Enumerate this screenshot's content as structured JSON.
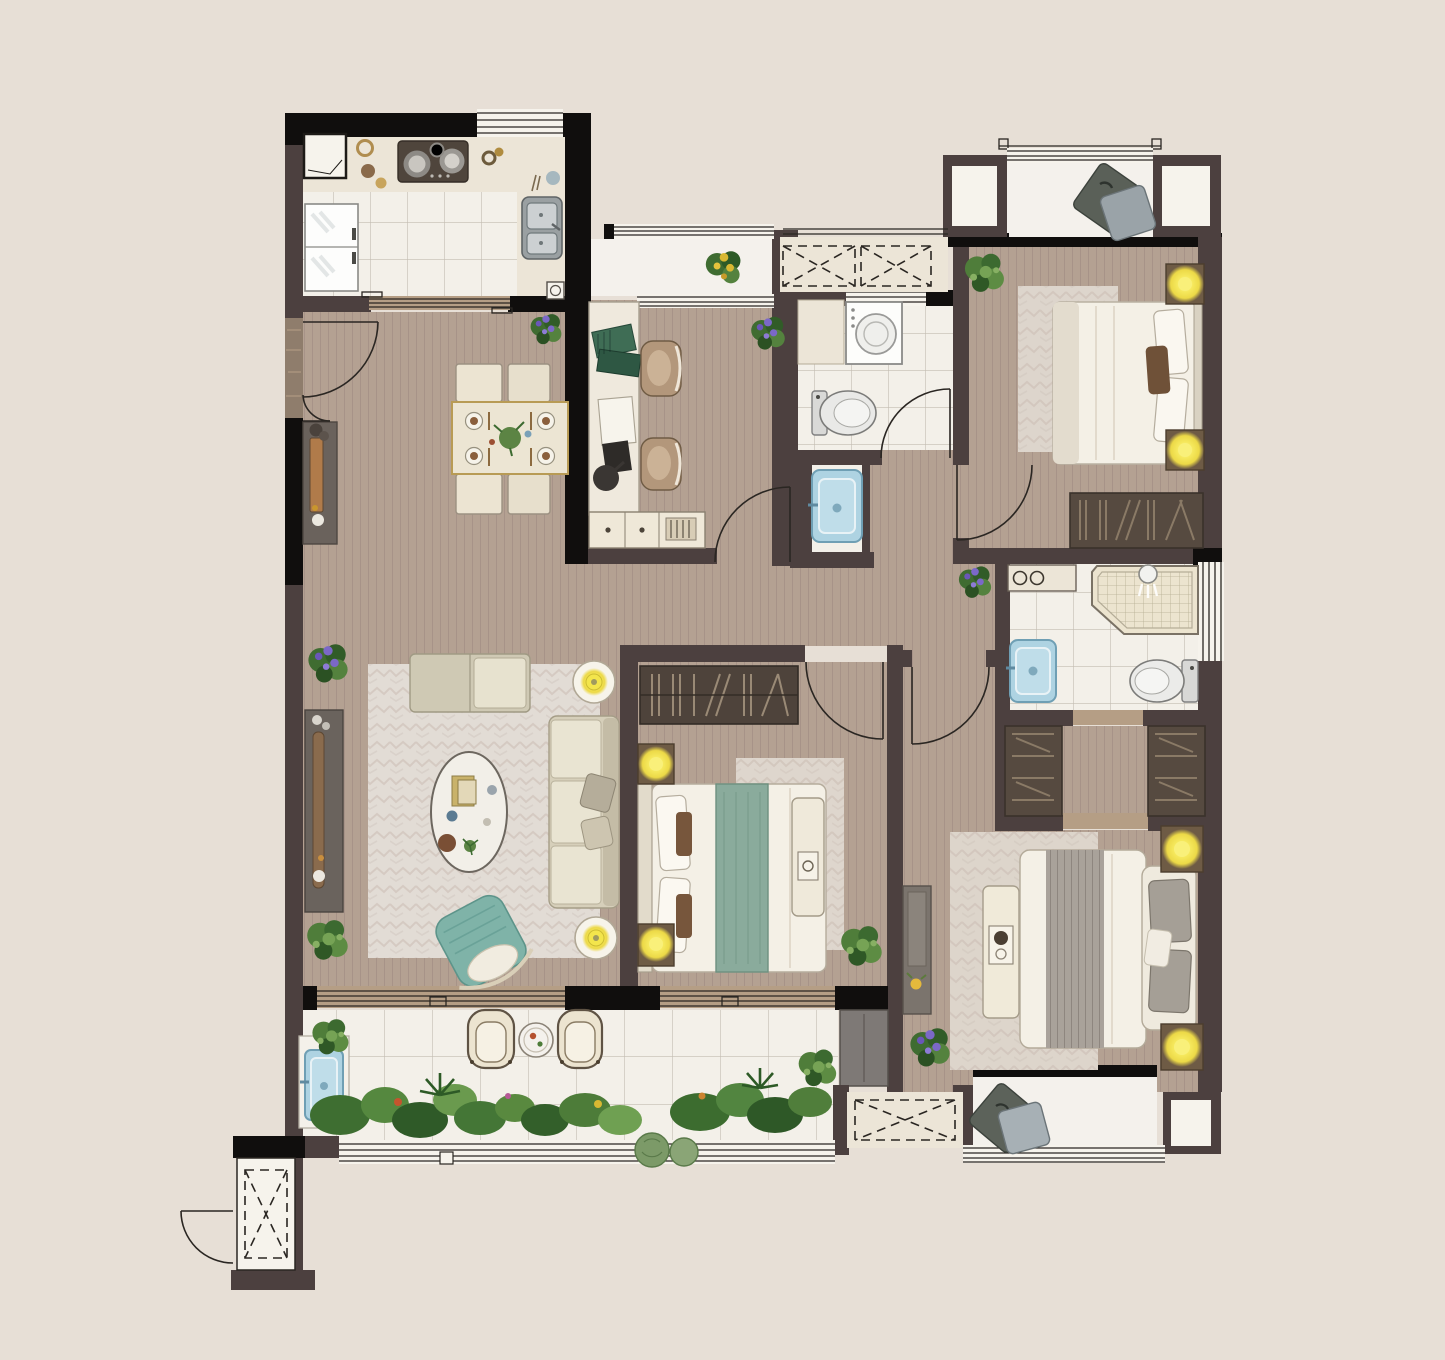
{
  "app": {
    "type": "residential-floor-plan",
    "view": "top-down-color-render",
    "visible_text": "none"
  },
  "palette": {
    "bg": "#e7dfd6",
    "wallDark": "#4c403f",
    "wallBlack": "#100e0d",
    "entryTexture": "#8f7d6c",
    "wood": "#b4a192",
    "woodLine": "#a38f84",
    "woodSill": "#b59e85",
    "tileWhite": "#f3f0e9",
    "tileLine": "#c3bdb2",
    "cream": "#ece5d7",
    "winWhite": "#f6f3ec",
    "lineDark": "#2a2622",
    "marble": "#f4f1ec",
    "rug": "#e2dcd5",
    "rugLine": "#c9bcb3",
    "sofa": "#d6cfba",
    "teal": "#7fb3a8",
    "bedRunnerGreen": "#8aab9c",
    "lampYellow": "#f3e54c",
    "nightstand": "#6e5b45",
    "wardrobe": "#564a40",
    "shelfDark": "#4e433b",
    "plantGreen": "#4d7c39",
    "plantDark": "#2f5a28",
    "flowerPurple": "#7b68c8",
    "flowerYellow": "#d8b832",
    "sinkBlue": "#aed3e2",
    "sinkBlueEdge": "#6f9fb4",
    "greyDoor": "#7e7976",
    "console": "#6a635d",
    "bedWhite": "#f4f0e6",
    "pillowGrey": "#a59f96",
    "shower": "#ece4cf",
    "stove": "#4f453c"
  },
  "rooms": [
    {
      "name": "kitchen",
      "floor": "white-tile",
      "furniture": [
        "cooktop",
        "double-sink",
        "fridge",
        "counter",
        "floor-drain",
        "corner-cabinet"
      ]
    },
    {
      "name": "dining-area",
      "floor": "wood",
      "furniture": [
        "dining-table",
        "dining-chairs-x4",
        "sideboard",
        "plants"
      ]
    },
    {
      "name": "study",
      "floor": "wood",
      "furniture": [
        "desk",
        "task-chairs-x2",
        "low-cabinet",
        "desk-lamp",
        "plant"
      ]
    },
    {
      "name": "study-balcony",
      "floor": "marble",
      "furniture": [
        "flower-pot"
      ]
    },
    {
      "name": "laundry-bathroom",
      "floor": "white-tile",
      "furniture": [
        "washing-machine",
        "toilet",
        "wash-basin"
      ]
    },
    {
      "name": "bedroom-north",
      "floor": "wood",
      "furniture": [
        "double-bed",
        "nightstands-x2",
        "lamps-x2",
        "rug",
        "wardrobe",
        "bay-window-seat",
        "plant"
      ]
    },
    {
      "name": "ensuite-bathroom",
      "floor": "white-tile",
      "furniture": [
        "walk-in-shower",
        "toilet",
        "wash-basin",
        "counter"
      ]
    },
    {
      "name": "walk-in-closet",
      "floor": "wood",
      "furniture": [
        "wardrobe-left",
        "wardrobe-right"
      ]
    },
    {
      "name": "bedroom-middle",
      "floor": "wood",
      "furniture": [
        "double-bed",
        "bookshelf",
        "bench",
        "nightstands-x2",
        "lamps-x2",
        "rug",
        "plant"
      ]
    },
    {
      "name": "living-room",
      "floor": "wood",
      "furniture": [
        "sofa",
        "chaise",
        "oval-coffee-table",
        "tv-console",
        "accent-chair",
        "round-lamp-tables-x2",
        "rug",
        "plants"
      ]
    },
    {
      "name": "master-bedroom",
      "floor": "wood",
      "furniture": [
        "double-bed",
        "bench",
        "nightstands-x2",
        "lamps-x2",
        "rug",
        "hall-console",
        "window-seat",
        "plant"
      ]
    },
    {
      "name": "balcony",
      "floor": "white-tile",
      "furniture": [
        "lounge-chairs-x2",
        "round-side-table",
        "wash-basin",
        "planting-bed",
        "storage-door"
      ]
    },
    {
      "name": "entry",
      "furniture": [
        "double-swing-door"
      ]
    },
    {
      "name": "service-shaft",
      "furniture": [
        "dashed-duct-box",
        "swing-door"
      ]
    }
  ],
  "openings": {
    "doors": [
      "entry-double-door",
      "kitchen-sliding-door",
      "study-door",
      "laundry-bath-door",
      "bedroom-north-door",
      "bedroom-middle-door",
      "master-suite-door",
      "shaft-door"
    ],
    "windows": [
      "kitchen-window",
      "study-balcony-window",
      "bay-window-north",
      "east-window",
      "balcony-railing",
      "living-balcony-slider",
      "bedroom-middle-window",
      "master-window-seat-glazing"
    ]
  },
  "ac_platforms": 3
}
